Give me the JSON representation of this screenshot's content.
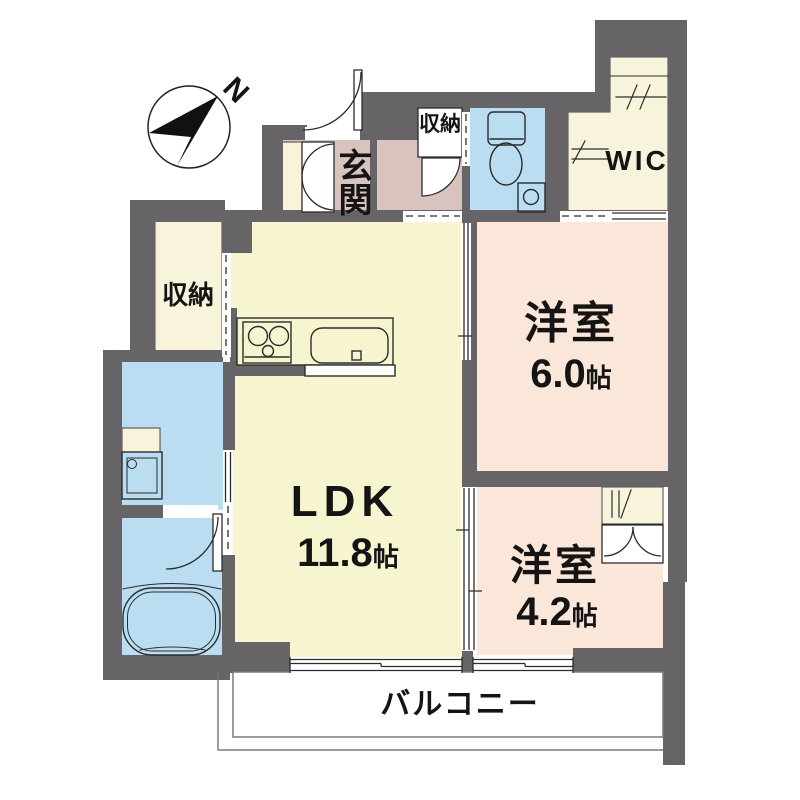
{
  "compass": {
    "label": "N"
  },
  "rooms": {
    "entrance": {
      "label": "玄関"
    },
    "hall_storage": {
      "label": "収納"
    },
    "wic": {
      "label": "WIC"
    },
    "bedroom_6": {
      "label": "洋室",
      "size_value": "6.0",
      "size_unit": "帖"
    },
    "ldk": {
      "label": "LDK",
      "size_value": "11.8",
      "size_unit": "帖"
    },
    "bedroom_4": {
      "label": "洋室",
      "size_value": "4.2",
      "size_unit": "帖"
    },
    "storage": {
      "label": "収納"
    },
    "balcony": {
      "label": "バルコニー"
    }
  },
  "colors": {
    "wall": "#676467",
    "room_ldk": "#F7F5CF",
    "room_bedroom": "#FBE7DA",
    "room_entrance": "#D9C3BF",
    "room_wet": "#BADDF2",
    "room_closet": "#F8F4DC",
    "line": "#2c2c2c",
    "balcony_line": "#7a7a7a",
    "compass_fill": "#111111"
  }
}
